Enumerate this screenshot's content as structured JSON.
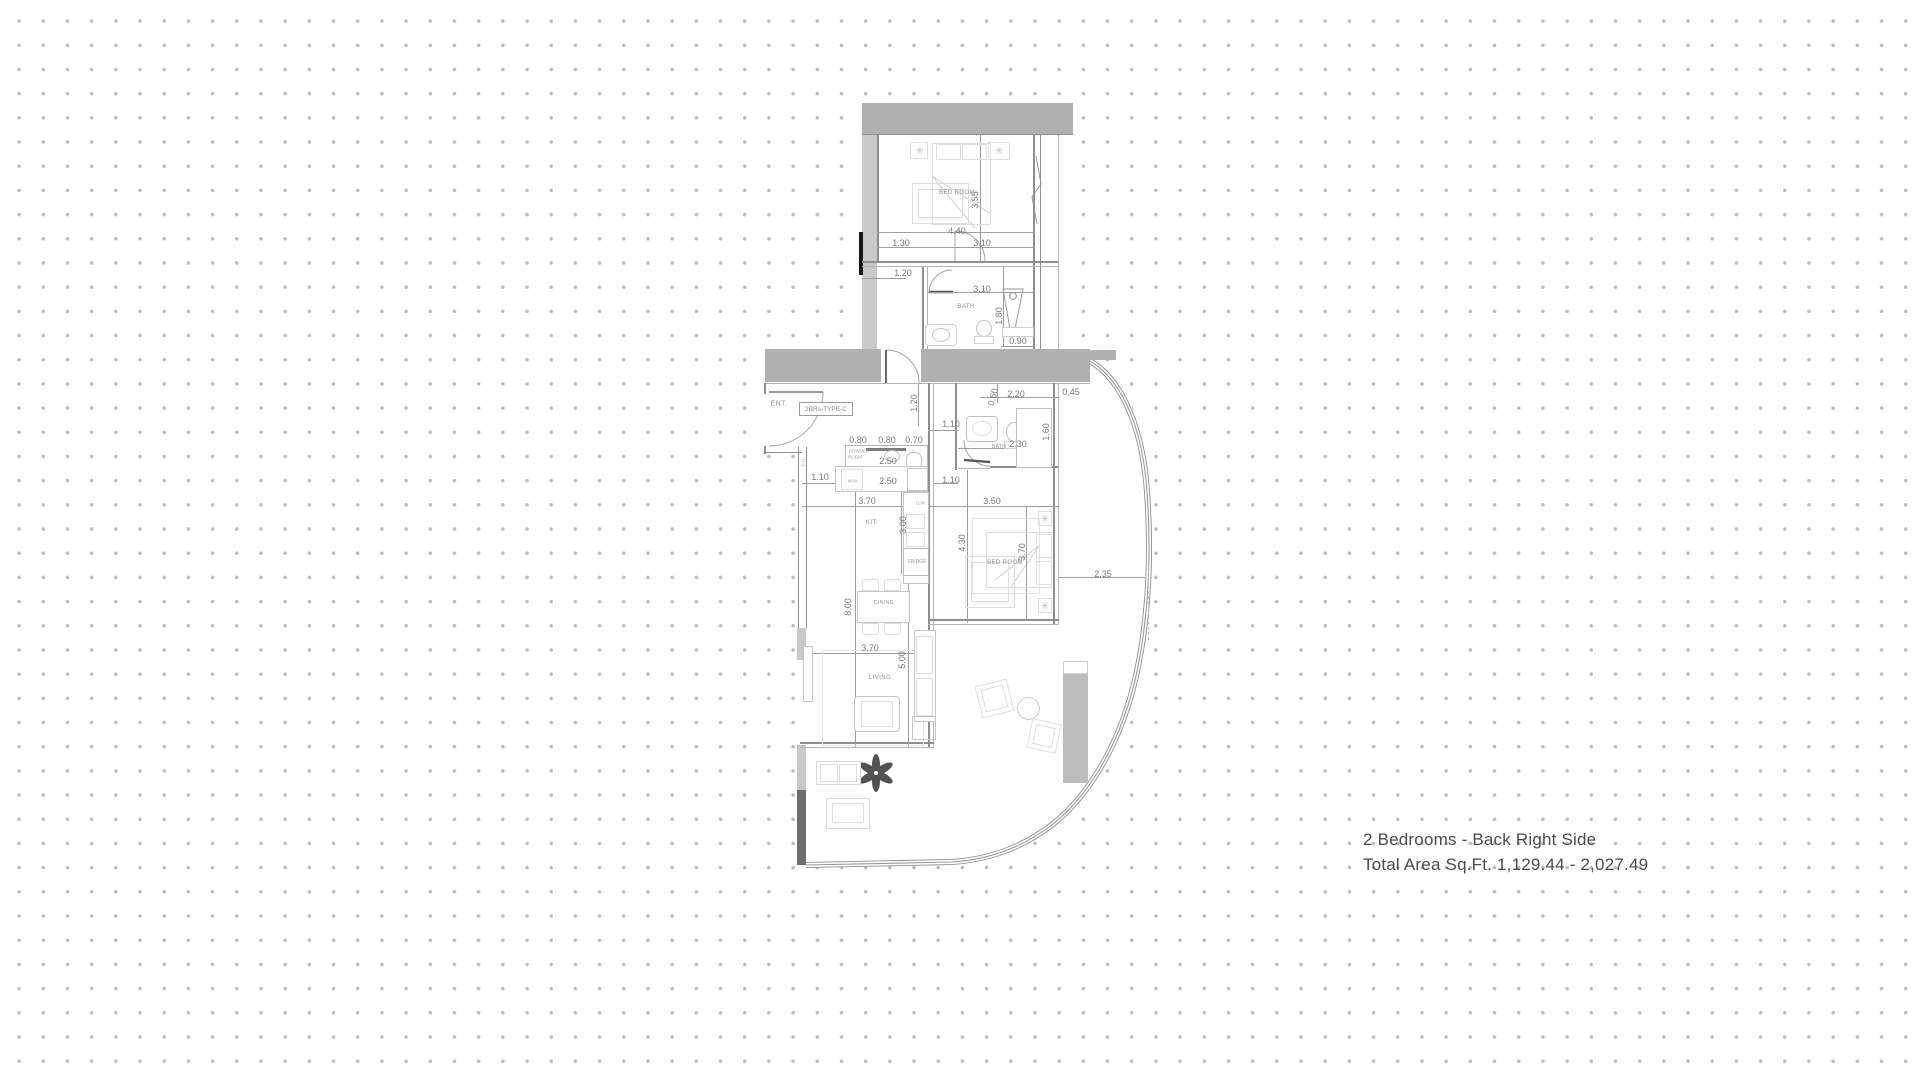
{
  "caption": {
    "line1": "2 Bedrooms - Back Right Side",
    "line2": "Total Area Sq.Ft. 1,129.44 - 2,027.49"
  },
  "plan": {
    "unit_type_label": "2BRs-TYPE-C",
    "colors": {
      "wall_gray": "#b0b0b0",
      "wall_light": "#c9c9c9",
      "wall_dark": "#6e6e6e",
      "line_gray": "#8f8f8f",
      "dot_gray": "#bcbcbc",
      "plant_gray": "#525252",
      "text_gray": "#787878"
    },
    "room_labels": [
      {
        "t": "BED ROOM",
        "x": 957,
        "y": 193,
        "s": 6
      },
      {
        "t": "BATH",
        "x": 966,
        "y": 307,
        "s": 6
      },
      {
        "t": "ENT.",
        "x": 779,
        "y": 404,
        "s": 7
      },
      {
        "t": "KIT.",
        "x": 872,
        "y": 523,
        "s": 6
      },
      {
        "t": "DINING",
        "x": 884,
        "y": 603,
        "s": 5
      },
      {
        "t": "LIVING",
        "x": 880,
        "y": 678,
        "s": 6
      },
      {
        "t": "BATH",
        "x": 999,
        "y": 447,
        "s": 5
      },
      {
        "t": "BED ROOM",
        "x": 1005,
        "y": 563,
        "s": 6
      }
    ],
    "fixture_labels": [
      {
        "t": "POWDER",
        "x": 859,
        "y": 451
      },
      {
        "t": "ROOM",
        "x": 855,
        "y": 457
      },
      {
        "t": "W.M.",
        "x": 853,
        "y": 481
      },
      {
        "t": "D.W.",
        "x": 921,
        "y": 503
      },
      {
        "t": "FRIDGE",
        "x": 917,
        "y": 562,
        "s": 5
      },
      {
        "t": "C.U.",
        "x": 803,
        "y": 462,
        "r": -90
      }
    ],
    "dimension_labels": [
      {
        "t": "4.40",
        "x": 957,
        "y": 231
      },
      {
        "t": "1.30",
        "x": 901,
        "y": 243
      },
      {
        "t": "3.10",
        "x": 982,
        "y": 243
      },
      {
        "t": "1.20",
        "x": 903,
        "y": 273
      },
      {
        "t": "3.10",
        "x": 982,
        "y": 289
      },
      {
        "t": "3.55",
        "x": 975,
        "y": 200,
        "r": -90
      },
      {
        "t": "1.80",
        "x": 999,
        "y": 316,
        "r": -90
      },
      {
        "t": "0.90",
        "x": 1018,
        "y": 341
      },
      {
        "t": "1.20",
        "x": 914,
        "y": 403,
        "r": -90
      },
      {
        "t": "2.20",
        "x": 1016,
        "y": 394
      },
      {
        "t": "0.45",
        "x": 1071,
        "y": 392
      },
      {
        "t": "0.60",
        "x": 993,
        "y": 397,
        "r": -75
      },
      {
        "t": "1.10",
        "x": 951,
        "y": 424
      },
      {
        "t": "2.30",
        "x": 1018,
        "y": 444
      },
      {
        "t": "1.60",
        "x": 1046,
        "y": 432,
        "r": -90
      },
      {
        "t": "0.80",
        "x": 858,
        "y": 440
      },
      {
        "t": "0.80",
        "x": 887,
        "y": 440
      },
      {
        "t": "0.70",
        "x": 914,
        "y": 440
      },
      {
        "t": "2.50",
        "x": 888,
        "y": 461
      },
      {
        "t": "2.50",
        "x": 888,
        "y": 481
      },
      {
        "t": "1.10",
        "x": 820,
        "y": 477
      },
      {
        "t": "1.10",
        "x": 951,
        "y": 480
      },
      {
        "t": "3.70",
        "x": 867,
        "y": 501
      },
      {
        "t": "3.50",
        "x": 992,
        "y": 501
      },
      {
        "t": "3.00",
        "x": 903,
        "y": 525,
        "r": -90
      },
      {
        "t": "4.30",
        "x": 962,
        "y": 543,
        "r": -90
      },
      {
        "t": "8.00",
        "x": 848,
        "y": 607,
        "r": -90
      },
      {
        "t": "3.70",
        "x": 1022,
        "y": 552,
        "r": -90
      },
      {
        "t": "2.35",
        "x": 1103,
        "y": 574
      },
      {
        "t": "3.70",
        "x": 870,
        "y": 648
      },
      {
        "t": "5.00",
        "x": 902,
        "y": 660,
        "r": -90
      }
    ]
  }
}
